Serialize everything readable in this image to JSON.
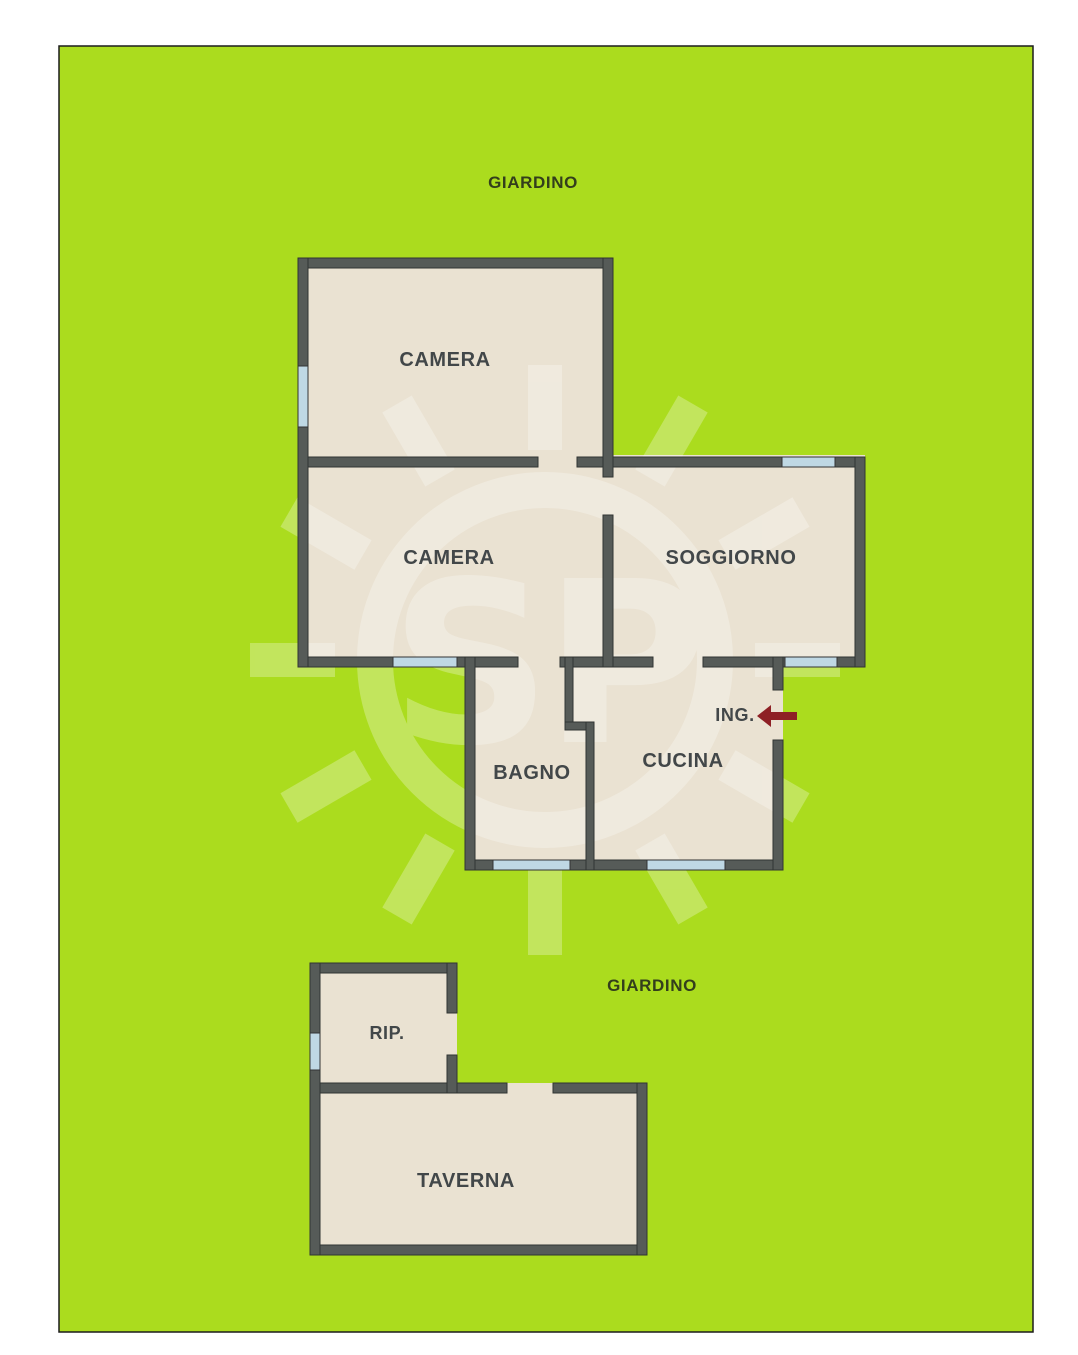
{
  "labels": {
    "giardino_top": "GIARDINO",
    "giardino_bottom": "GIARDINO",
    "camera_top": "CAMERA",
    "camera_mid": "CAMERA",
    "soggiorno": "SOGGIORNO",
    "bagno": "BAGNO",
    "cucina": "CUCINA",
    "ingresso": "ING.",
    "rip": "RIP.",
    "taverna": "TAVERNA"
  },
  "colors": {
    "garden": "#abdc1e",
    "garden_edge": "#1c1c1c",
    "floor": "#eae2d2",
    "wall": "#565b58",
    "wall_edge": "#303433",
    "window": "#bfd8e4",
    "window_edge": "#333333",
    "room_text": "#424749",
    "garden_text": "#333e1c",
    "arrow": "#8e2025"
  },
  "watermark": {
    "text": "SP",
    "color": "#ffffff",
    "opacity": "0.28"
  }
}
